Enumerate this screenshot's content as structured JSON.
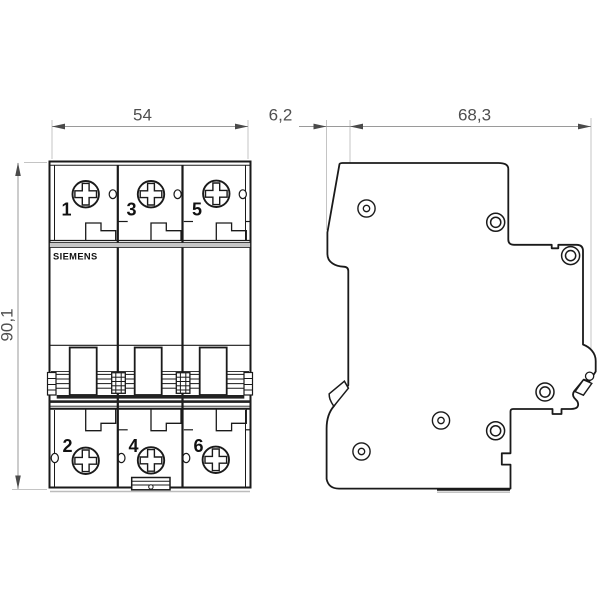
{
  "front_view": {
    "brand": "SIEMENS",
    "terminals_top": [
      "1",
      "3",
      "5"
    ],
    "terminals_bottom": [
      "2",
      "4",
      "6"
    ]
  },
  "dimensions": {
    "front_width": "54",
    "front_depth": "6,2",
    "side_depth": "68,3",
    "height": "90,1"
  },
  "colors": {
    "background": "#ffffff",
    "outline": "#1a1a1a",
    "dimension_line": "#9a9a9a",
    "extension_line": "#c4c4c4",
    "dimension_text": "#4f4f4f",
    "label_text": "#111111",
    "separator_band": "#c6c6c6"
  }
}
